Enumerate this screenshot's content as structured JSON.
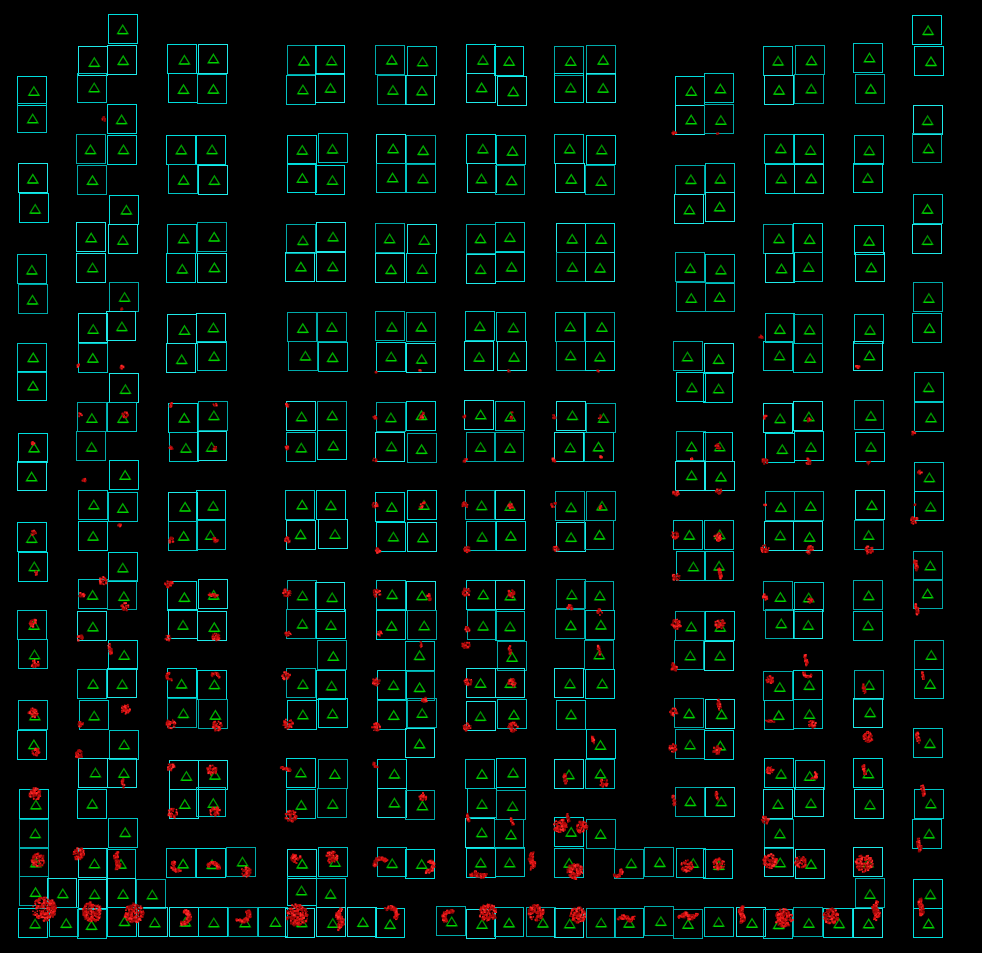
{
  "scene": {
    "width": 982,
    "height": 953,
    "background": "#000000"
  },
  "colors": {
    "box_strokes": [
      "#00c6c6",
      "#00dede",
      "#00aaaa",
      "#1fe9e9"
    ],
    "triangle_strokes": [
      "#009c00",
      "#00ae00",
      "#008f00"
    ],
    "triangle_base": "#00d400",
    "blob_palette": [
      "#5e0000",
      "#8a0404",
      "#a80808",
      "#c60d0d",
      "#e81616",
      "#ff2b2b"
    ]
  },
  "grid": {
    "x0": 18,
    "y0": 15,
    "dx": 29.84,
    "dy": 29.75,
    "cell": 30,
    "rows": [
      "0001000000000000000000000000001",
      "0011011001101101101100000110101",
      "1010011001101101101100110110100",
      "1001000000000000000000110000001",
      "0011011001101101101100000110101",
      "1010011001101101101100110110100",
      "1001000000000000000000110000001",
      "0011011001101101101100000110101",
      "1010011001101101101100110110100",
      "1001000000000000000000110000001",
      "0011011001101101101100000110101",
      "1010011001101101101100110110100",
      "1001000000000000000000110000001",
      "0011011001101101101100000110101",
      "1010011001101101101100110110100",
      "1001000000000000000000110000001",
      "0011011001101101101100000110101",
      "1010011001101101101100110110100",
      "1001000000000000000000110000001",
      "0011011001101101101100000110101",
      "1010011001101101101100110110100",
      "1001000000100100100100110000001",
      "0011011001101101101100000110101",
      "1010011001101101101000110110100",
      "1001000000000100000100110000001",
      "0011011001101001101100000110100",
      "1010011001101101100000110110101",
      "1001000000000001101100000100001",
      "1011011101101101101011110110100",
      "1111100001100000000000000000101",
      "1111111111111011111111111111101"
    ]
  },
  "blobs": [
    [
      44,
      909,
      12,
      "m"
    ],
    [
      92,
      912,
      10,
      "m"
    ],
    [
      134,
      913,
      10,
      "m"
    ],
    [
      182,
      917,
      9,
      "a"
    ],
    [
      242,
      915,
      9,
      "a"
    ],
    [
      297,
      915,
      11,
      "m"
    ],
    [
      340,
      919,
      10,
      "v"
    ],
    [
      390,
      914,
      9,
      "a"
    ],
    [
      450,
      917,
      8,
      "a"
    ],
    [
      488,
      913,
      9,
      "m"
    ],
    [
      536,
      913,
      8,
      "m"
    ],
    [
      578,
      915,
      8,
      "m"
    ],
    [
      627,
      918,
      8,
      "h"
    ],
    [
      688,
      916,
      9,
      "h"
    ],
    [
      742,
      915,
      8,
      "v"
    ],
    [
      784,
      918,
      9,
      "m"
    ],
    [
      831,
      916,
      8,
      "m"
    ],
    [
      876,
      911,
      9,
      "v"
    ],
    [
      921,
      907,
      8,
      "v"
    ],
    [
      38,
      860,
      7,
      "m"
    ],
    [
      117,
      861,
      8,
      "v"
    ],
    [
      79,
      854,
      6,
      "m"
    ],
    [
      178,
      866,
      7,
      "a"
    ],
    [
      213,
      868,
      7,
      "a"
    ],
    [
      246,
      872,
      5,
      "m"
    ],
    [
      296,
      858,
      5,
      "m"
    ],
    [
      332,
      857,
      6,
      "m"
    ],
    [
      381,
      864,
      8,
      "a"
    ],
    [
      427,
      866,
      8,
      "a"
    ],
    [
      478,
      875,
      8,
      "h"
    ],
    [
      532,
      861,
      8,
      "v"
    ],
    [
      575,
      871,
      8,
      "m"
    ],
    [
      617,
      872,
      6,
      "a"
    ],
    [
      687,
      866,
      6,
      "m"
    ],
    [
      719,
      864,
      6,
      "m"
    ],
    [
      770,
      861,
      7,
      "m"
    ],
    [
      801,
      862,
      6,
      "m"
    ],
    [
      864,
      863,
      9,
      "m"
    ],
    [
      919,
      845,
      6,
      "v"
    ],
    [
      35,
      664,
      4,
      "m"
    ],
    [
      33,
      713,
      5,
      "m"
    ],
    [
      36,
      752,
      4,
      "m"
    ],
    [
      35,
      794,
      6,
      "m"
    ],
    [
      110,
      649,
      5,
      "v"
    ],
    [
      126,
      709,
      5,
      "m"
    ],
    [
      79,
      754,
      4,
      "m"
    ],
    [
      123,
      783,
      4,
      "v"
    ],
    [
      81,
      724,
      3,
      "m"
    ],
    [
      171,
      676,
      5,
      "a"
    ],
    [
      215,
      677,
      5,
      "a"
    ],
    [
      171,
      724,
      5,
      "m"
    ],
    [
      217,
      726,
      5,
      "m"
    ],
    [
      171,
      767,
      4,
      "m"
    ],
    [
      212,
      770,
      5,
      "m"
    ],
    [
      173,
      813,
      5,
      "m"
    ],
    [
      215,
      812,
      5,
      "m"
    ],
    [
      286,
      676,
      4,
      "m"
    ],
    [
      288,
      724,
      5,
      "m"
    ],
    [
      286,
      769,
      5,
      "h"
    ],
    [
      291,
      816,
      6,
      "m"
    ],
    [
      169,
      584,
      4,
      "m"
    ],
    [
      213,
      595,
      5,
      "h"
    ],
    [
      216,
      637,
      4,
      "m"
    ],
    [
      168,
      638,
      3,
      "m"
    ],
    [
      287,
      593,
      4,
      "m"
    ],
    [
      288,
      634,
      3,
      "m"
    ],
    [
      103,
      581,
      4,
      "m"
    ],
    [
      82,
      595,
      3,
      "m"
    ],
    [
      125,
      607,
      4,
      "m"
    ],
    [
      80,
      638,
      3,
      "m"
    ],
    [
      33,
      623,
      4,
      "m"
    ],
    [
      376,
      682,
      4,
      "m"
    ],
    [
      421,
      645,
      3,
      "v"
    ],
    [
      376,
      727,
      4,
      "m"
    ],
    [
      424,
      700,
      3,
      "m"
    ],
    [
      466,
      645,
      4,
      "m"
    ],
    [
      510,
      650,
      4,
      "v"
    ],
    [
      468,
      682,
      4,
      "m"
    ],
    [
      512,
      683,
      4,
      "m"
    ],
    [
      467,
      727,
      4,
      "m"
    ],
    [
      513,
      727,
      5,
      "m"
    ],
    [
      377,
      593,
      4,
      "m"
    ],
    [
      429,
      597,
      4,
      "v"
    ],
    [
      466,
      592,
      4,
      "m"
    ],
    [
      511,
      594,
      4,
      "m"
    ],
    [
      380,
      634,
      3,
      "m"
    ],
    [
      467,
      630,
      3,
      "m"
    ],
    [
      377,
      764,
      4,
      "a"
    ],
    [
      423,
      797,
      4,
      "m"
    ],
    [
      570,
      607,
      3,
      "m"
    ],
    [
      600,
      612,
      3,
      "m"
    ],
    [
      599,
      650,
      4,
      "v"
    ],
    [
      593,
      740,
      4,
      "v"
    ],
    [
      565,
      778,
      5,
      "v"
    ],
    [
      604,
      783,
      4,
      "m"
    ],
    [
      560,
      826,
      7,
      "m"
    ],
    [
      582,
      827,
      6,
      "m"
    ],
    [
      568,
      818,
      4,
      "v"
    ],
    [
      512,
      822,
      4,
      "v"
    ],
    [
      468,
      818,
      4,
      "v"
    ],
    [
      674,
      667,
      4,
      "m"
    ],
    [
      806,
      660,
      5,
      "v"
    ],
    [
      676,
      577,
      4,
      "m"
    ],
    [
      720,
      573,
      5,
      "v"
    ],
    [
      676,
      624,
      5,
      "m"
    ],
    [
      720,
      624,
      5,
      "m"
    ],
    [
      765,
      549,
      4,
      "m"
    ],
    [
      810,
      550,
      4,
      "m"
    ],
    [
      869,
      550,
      4,
      "m"
    ],
    [
      916,
      565,
      5,
      "v"
    ],
    [
      917,
      609,
      5,
      "v"
    ],
    [
      765,
      597,
      3,
      "m"
    ],
    [
      810,
      600,
      3,
      "m"
    ],
    [
      674,
      712,
      4,
      "m"
    ],
    [
      719,
      705,
      5,
      "v"
    ],
    [
      673,
      748,
      4,
      "m"
    ],
    [
      717,
      750,
      4,
      "m"
    ],
    [
      674,
      800,
      5,
      "v"
    ],
    [
      717,
      796,
      4,
      "v"
    ],
    [
      770,
      680,
      4,
      "m"
    ],
    [
      808,
      673,
      5,
      "a"
    ],
    [
      770,
      721,
      4,
      "h"
    ],
    [
      812,
      724,
      4,
      "m"
    ],
    [
      770,
      770,
      4,
      "m"
    ],
    [
      813,
      775,
      5,
      "a"
    ],
    [
      765,
      820,
      4,
      "m"
    ],
    [
      864,
      689,
      4,
      "v"
    ],
    [
      868,
      737,
      5,
      "m"
    ],
    [
      864,
      770,
      5,
      "v"
    ],
    [
      923,
      676,
      4,
      "v"
    ],
    [
      918,
      738,
      5,
      "v"
    ],
    [
      923,
      790,
      5,
      "v"
    ],
    [
      375,
      460,
      2,
      "m"
    ],
    [
      465,
      460,
      2,
      "m"
    ],
    [
      554,
      460,
      2,
      "m"
    ],
    [
      375,
      505,
      3,
      "m"
    ],
    [
      421,
      506,
      2,
      "m"
    ],
    [
      465,
      505,
      3,
      "m"
    ],
    [
      511,
      506,
      3,
      "m"
    ],
    [
      554,
      505,
      3,
      "m"
    ],
    [
      600,
      507,
      2,
      "m"
    ],
    [
      378,
      550,
      3,
      "m"
    ],
    [
      467,
      549,
      3,
      "m"
    ],
    [
      556,
      549,
      3,
      "m"
    ],
    [
      171,
      540,
      3,
      "m"
    ],
    [
      215,
      540,
      3,
      "m"
    ],
    [
      287,
      540,
      3,
      "m"
    ],
    [
      675,
      535,
      4,
      "m"
    ],
    [
      718,
      537,
      4,
      "m"
    ],
    [
      676,
      493,
      3,
      "m"
    ],
    [
      719,
      491,
      3,
      "m"
    ],
    [
      765,
      461,
      3,
      "m"
    ],
    [
      809,
      463,
      3,
      "m"
    ],
    [
      869,
      463,
      2,
      "m"
    ],
    [
      914,
      433,
      2,
      "m"
    ],
    [
      914,
      520,
      4,
      "m"
    ],
    [
      33,
      533,
      3,
      "m"
    ],
    [
      36,
      573,
      2,
      "m"
    ],
    [
      171,
      448,
      2,
      "m"
    ],
    [
      215,
      448,
      2,
      "m"
    ],
    [
      287,
      448,
      2,
      "m"
    ],
    [
      84,
      480,
      2,
      "m"
    ],
    [
      120,
      525,
      2,
      "m"
    ],
    [
      718,
      447,
      3,
      "m"
    ],
    [
      375,
      417,
      2,
      "m"
    ],
    [
      465,
      417,
      2,
      "m"
    ],
    [
      554,
      417,
      2,
      "m"
    ],
    [
      600,
      417,
      2,
      "m"
    ],
    [
      421,
      417,
      2,
      "m"
    ],
    [
      511,
      417,
      2,
      "m"
    ],
    [
      122,
      367,
      2,
      "m"
    ],
    [
      125,
      415,
      3,
      "m"
    ],
    [
      80,
      415,
      2,
      "m"
    ],
    [
      33,
      443,
      2,
      "m"
    ],
    [
      171,
      405,
      2,
      "m"
    ],
    [
      215,
      405,
      2,
      "m"
    ],
    [
      287,
      405,
      2,
      "m"
    ],
    [
      765,
      417,
      2,
      "m"
    ],
    [
      809,
      420,
      2,
      "m"
    ],
    [
      761,
      337,
      2,
      "m"
    ],
    [
      104,
      119,
      2,
      "m"
    ],
    [
      376,
      372,
      1,
      "m"
    ],
    [
      420,
      371,
      1,
      "m"
    ],
    [
      509,
      371,
      1,
      "m"
    ],
    [
      598,
      371,
      1,
      "m"
    ],
    [
      674,
      133,
      2,
      "m"
    ],
    [
      718,
      133,
      1,
      "m"
    ],
    [
      79,
      366,
      2,
      "m"
    ],
    [
      858,
      367,
      2,
      "m"
    ],
    [
      122,
      309,
      1,
      "m"
    ],
    [
      920,
      472,
      2,
      "m"
    ],
    [
      423,
      413,
      1,
      "m"
    ],
    [
      512,
      413,
      1,
      "m"
    ],
    [
      601,
      457,
      1,
      "m"
    ],
    [
      808,
      459,
      1,
      "m"
    ],
    [
      692,
      459,
      1,
      "m"
    ],
    [
      424,
      503,
      1,
      "m"
    ],
    [
      765,
      505,
      1,
      "m"
    ],
    [
      915,
      505,
      1,
      "m"
    ]
  ]
}
